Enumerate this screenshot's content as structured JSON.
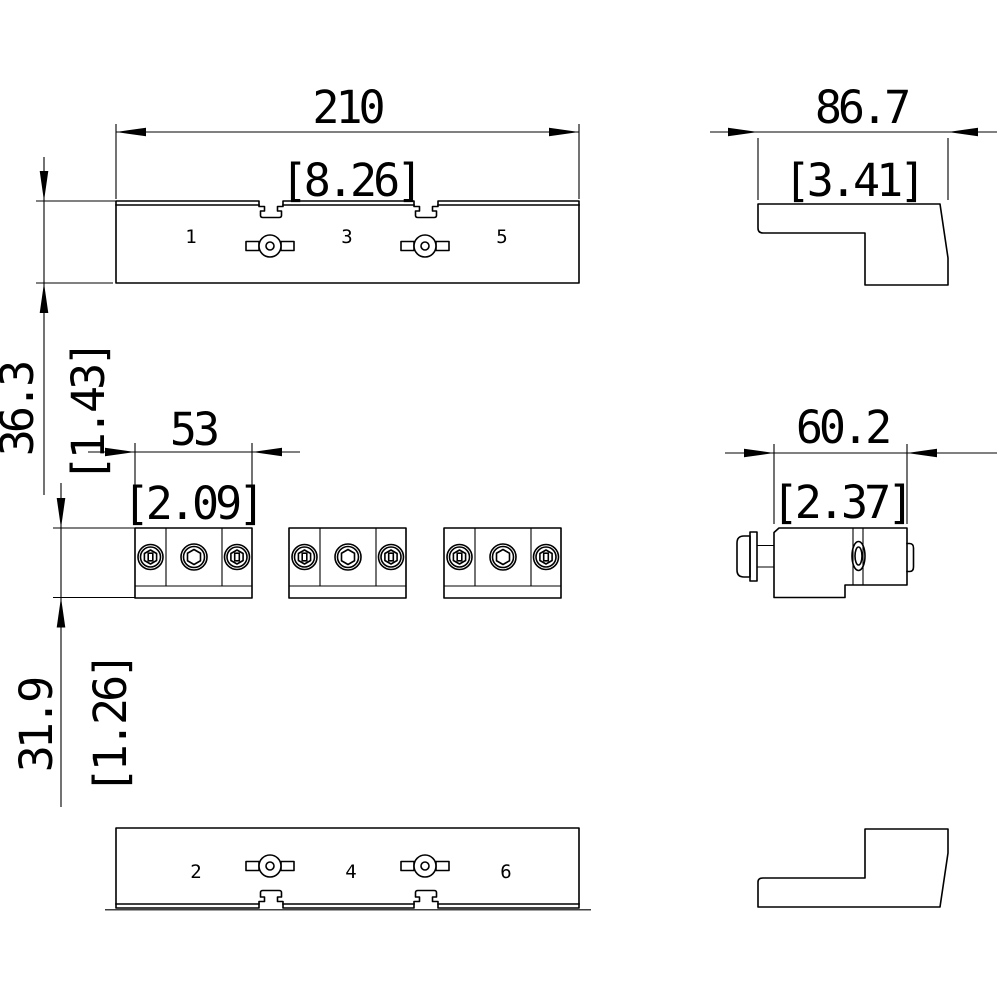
{
  "drawing": {
    "colors": {
      "line": "#000000",
      "background": "#ffffff"
    },
    "dimensions": {
      "top_overall": {
        "mm": "210",
        "inch": "[8.26]"
      },
      "side_overall": {
        "mm": "86.7",
        "inch": "[3.41]"
      },
      "front_height": {
        "mm": "36.3",
        "inch": "[1.43]"
      },
      "block_width": {
        "mm": "53",
        "inch": "[2.09]"
      },
      "block_depth": {
        "mm": "60.2",
        "inch": "[2.37]"
      },
      "block_height": {
        "mm": "31.9",
        "inch": "[1.26]"
      }
    },
    "terminal_labels": {
      "top": [
        "1",
        "3",
        "5"
      ],
      "bottom": [
        "2",
        "4",
        "6"
      ]
    }
  }
}
